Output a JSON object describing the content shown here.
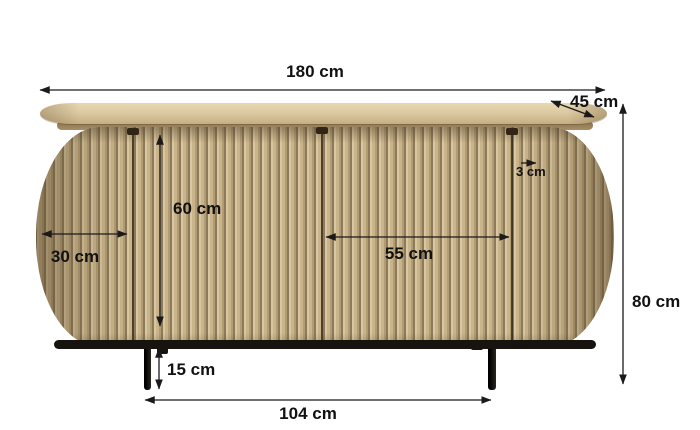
{
  "figure": {
    "type": "product dimension diagram",
    "subject": "slatted wood sideboard with rounded ends and black metal legs"
  },
  "colors": {
    "background": "#ffffff",
    "wood": "#c9b48b",
    "wood_groove": "#8d7a5a",
    "top_surface": "#dcc9a1",
    "metal": "#17130e",
    "dimension_lines": "#1a1a1a"
  },
  "dimensions": {
    "total_width": "180 cm",
    "depth": "45 cm",
    "total_height": "80 cm",
    "door_height": "60 cm",
    "side_door_width": "30 cm",
    "center_door_width": "55 cm",
    "top_thickness": "3 cm",
    "leg_height": "15 cm",
    "legs_outer_span": "104 cm"
  }
}
